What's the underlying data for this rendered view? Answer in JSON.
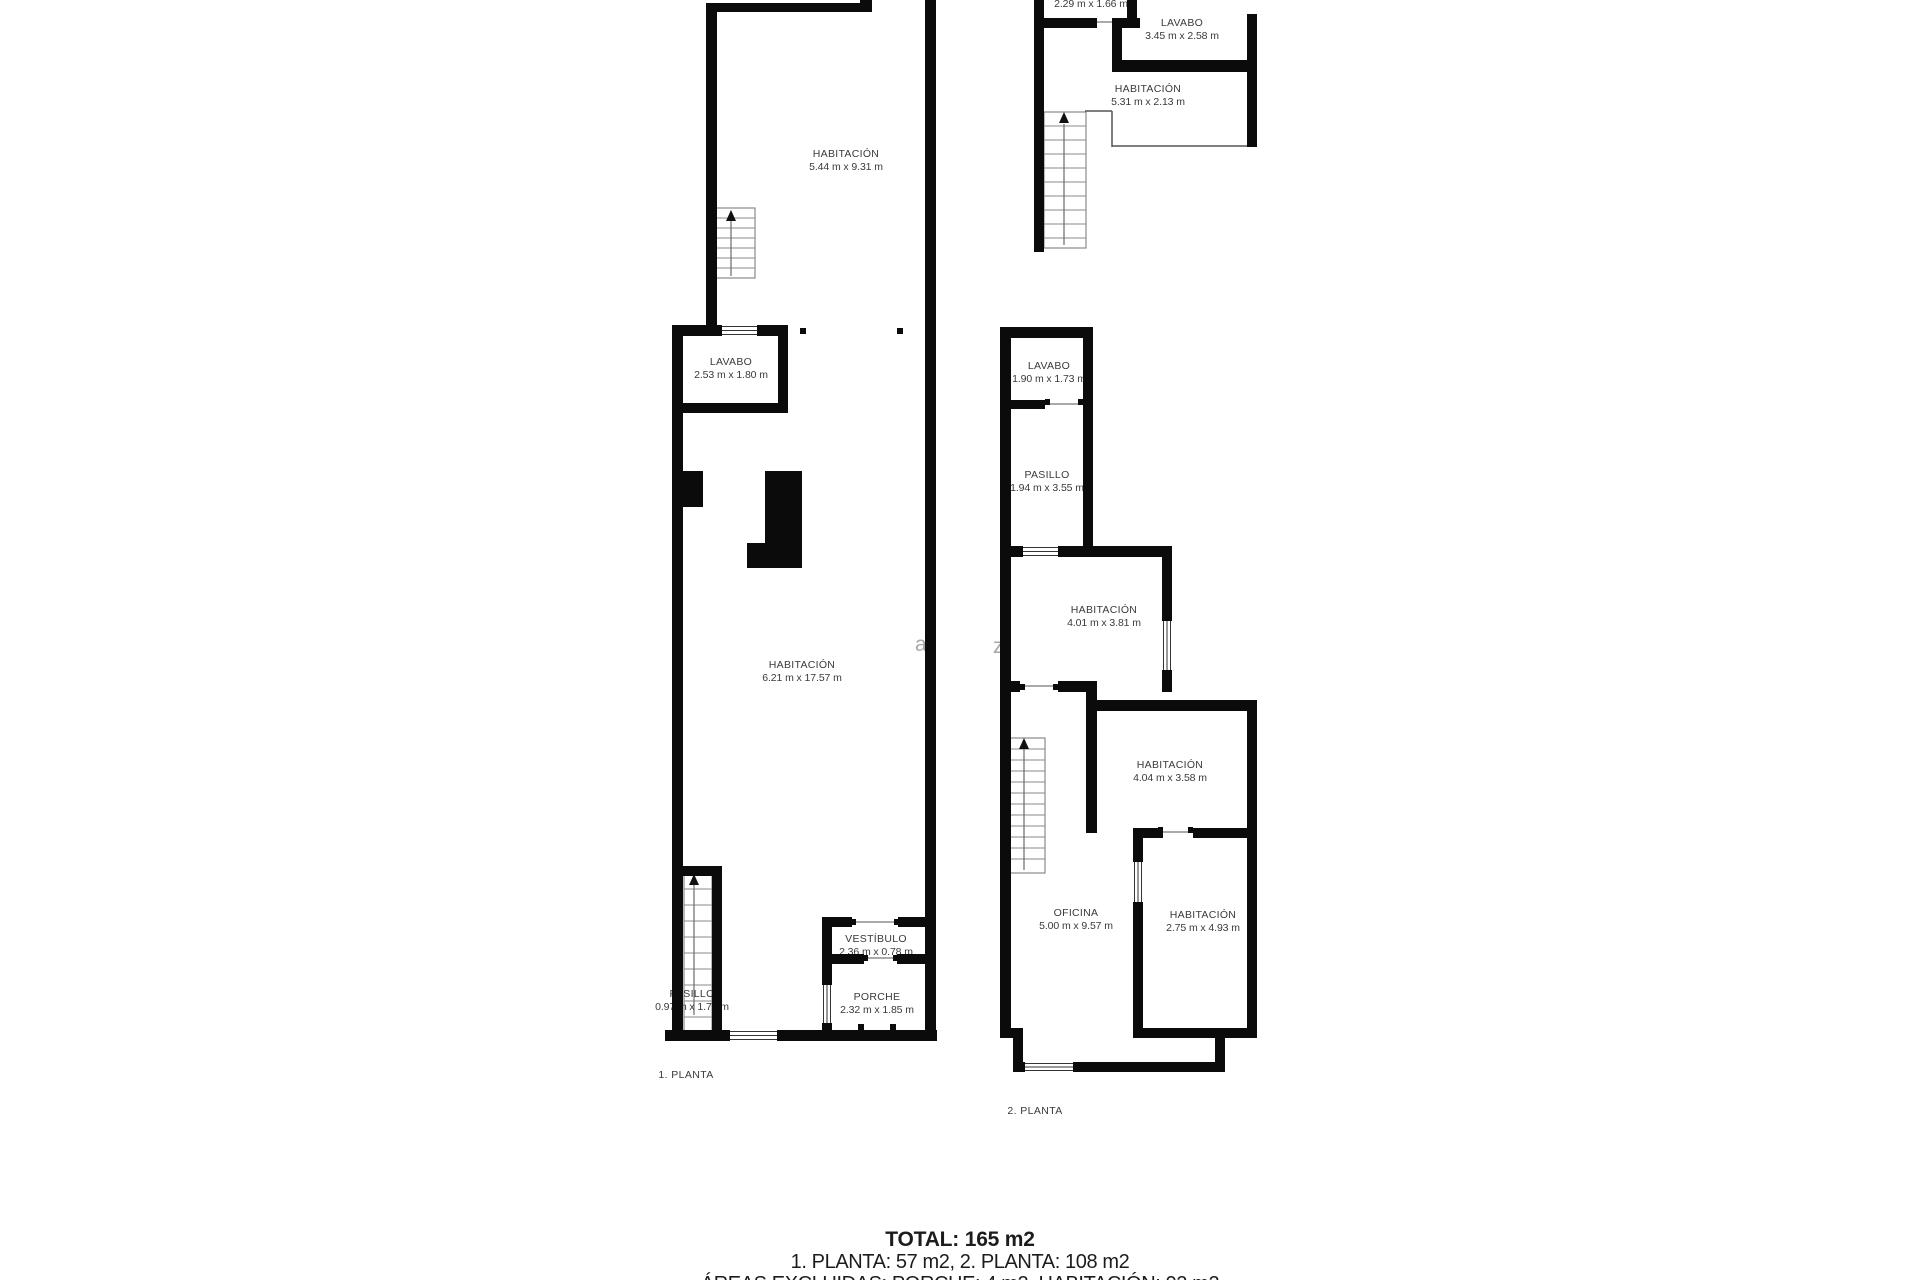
{
  "plans": {
    "floor1": {
      "label": "1. PLANTA",
      "rooms": {
        "habitacion_top": {
          "name": "HABITACIÓN",
          "dims": "5.44 m x 9.31 m"
        },
        "lavabo": {
          "name": "LAVABO",
          "dims": "2.53 m x 1.80 m"
        },
        "habitacion_main": {
          "name": "HABITACIÓN",
          "dims": "6.21 m x 17.57 m"
        },
        "pasillo": {
          "name": "PASILLO",
          "dims": "0.97 m x 1.76 m"
        },
        "vestibulo": {
          "name": "VESTÍBULO",
          "dims": "2.36 m x 0.78 m"
        },
        "porche": {
          "name": "PORCHE",
          "dims": "2.32 m x 1.85 m"
        }
      }
    },
    "floor2": {
      "label": "2. PLANTA",
      "rooms": {
        "lavabo": {
          "name": "LAVABO",
          "dims": "1.90 m x 1.73 m"
        },
        "pasillo": {
          "name": "PASILLO",
          "dims": "1.94 m x 3.55 m"
        },
        "habitacion_a": {
          "name": "HABITACIÓN",
          "dims": "4.01 m x 3.81 m"
        },
        "habitacion_b": {
          "name": "HABITACIÓN",
          "dims": "4.04 m x 3.58 m"
        },
        "oficina": {
          "name": "OFICINA",
          "dims": "5.00 m x 9.57 m"
        },
        "habitacion_c": {
          "name": "HABITACIÓN",
          "dims": "2.75 m x 4.93 m"
        }
      }
    },
    "fragment_top": {
      "rooms": {
        "room_cut": {
          "dims": "2.29 m x 1.66 m"
        },
        "lavabo": {
          "name": "LAVABO",
          "dims": "3.45 m x 2.58 m"
        },
        "habitacion": {
          "name": "HABITACIÓN",
          "dims": "5.31 m x 2.13 m"
        }
      }
    }
  },
  "summary": {
    "total_line": "TOTAL: 165 m2",
    "floors_line": "1. PLANTA: 57 m2, 2. PLANTA: 108 m2",
    "excluded_line": "ÁREAS EXCLUIDAS: PORCHE: 4 m2, HABITACIÓN: 92 m2"
  },
  "watermark": {
    "letter_a": "a",
    "letter_z": "z"
  },
  "colors": {
    "wall": "#0b0b0b",
    "label_text": "#3a3a3a",
    "stair_line": "#8a8a8a",
    "watermark": "#a8a8a8"
  }
}
